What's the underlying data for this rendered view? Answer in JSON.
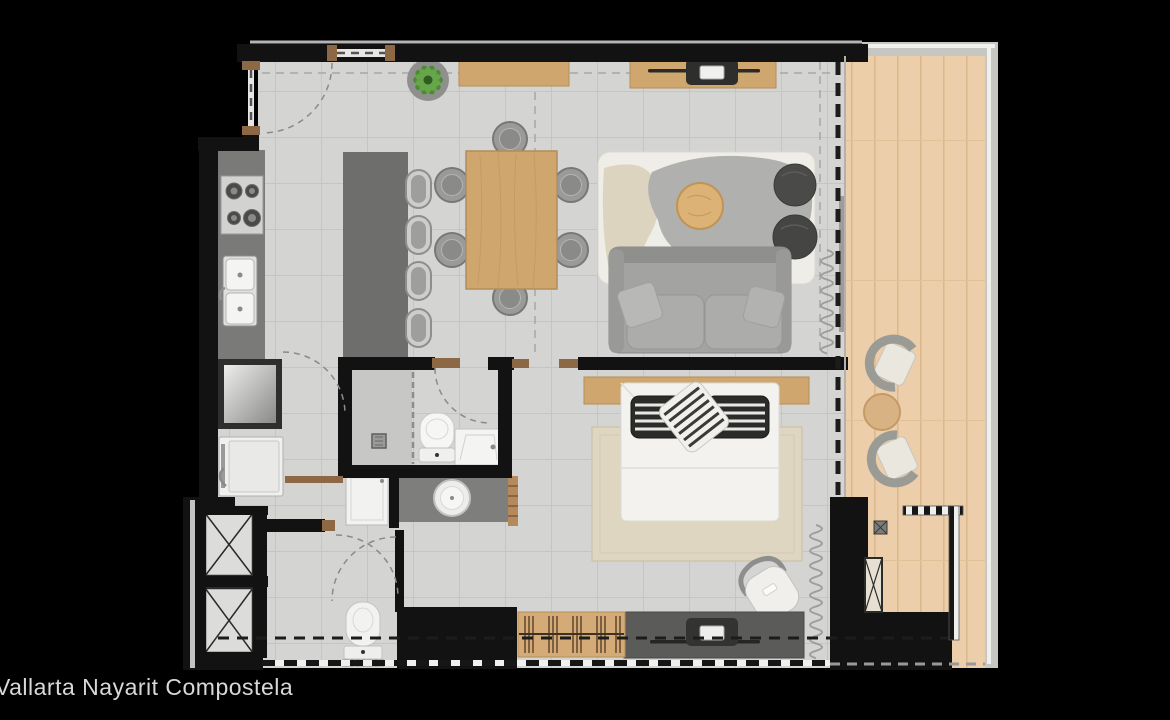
{
  "caption": {
    "text": "Vallarta Nayarit Compostela"
  },
  "palette": {
    "background": "#000000",
    "wall_black": "#121212",
    "terrace_wall_gray": "#c6c6c2",
    "floor_tile": "#d4d4d2",
    "tile_grid": "#c5c5c3",
    "terrace_wood": "#ecceaa",
    "furniture_wood": "#cfa76e",
    "counter_gray": "#7a7a78",
    "island_gray": "#6e6e6c",
    "dresser_gray": "#5b5b59",
    "fixture_white": "#f2f2f0",
    "sofa_gray": "#a3a3a1",
    "pouf_dark": "#4a4a48",
    "rug_cream": "#efede7",
    "rug_gray_blob": "#b0b0ae",
    "bed_rug_beige": "#ded6c1",
    "door_jamb_brown": "#8d6844",
    "plant_green": "#55923b",
    "caption_text": "#d8d8d8"
  },
  "floor_plan": {
    "type": "residential-apartment-top-view-floor-plan",
    "elements": [
      "entry-door",
      "kitchen-counter",
      "stove",
      "kitchen-sink",
      "kitchen-island",
      "bar-stools",
      "refrigerator",
      "washer",
      "dining-table",
      "dining-chairs",
      "sideboard",
      "potted-plant",
      "tv-console",
      "television",
      "living-rug",
      "coffee-table",
      "ottomans",
      "sofa",
      "shower",
      "toilet",
      "bathroom-sink",
      "vanity-basin",
      "towel-shelf",
      "shower-cabin",
      "wc-toilet",
      "service-closets",
      "bed",
      "headboard",
      "bed-pillows",
      "bedroom-rug",
      "desk-chair",
      "bedroom-dresser",
      "slatted-bench",
      "curtains",
      "terrace-deck",
      "lounge-chairs",
      "side-table",
      "terrace-railing"
    ]
  }
}
